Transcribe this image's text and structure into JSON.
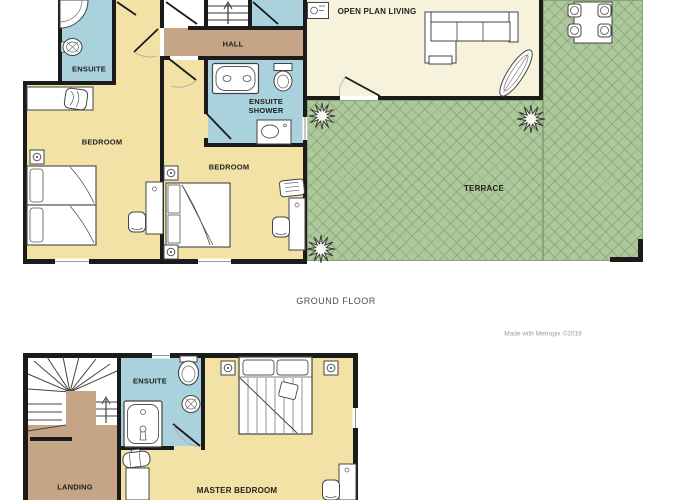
{
  "colors": {
    "wall": "#1b1b1b",
    "yellow": "#F2E2A6",
    "blue": "#A9D2DC",
    "brown": "#C5A586",
    "cream": "#F6F2DC",
    "green": "#ADC99C",
    "green-line": "#87A576",
    "label": "#1f1f1f",
    "caption": "#4f4f4f",
    "credit": "#9b9b9b"
  },
  "ground_floor": {
    "caption": "GROUND FLOOR",
    "rooms": {
      "ensuite": "ENSUITE",
      "hall": "HALL",
      "open_plan_living": "OPEN PLAN LIVING",
      "ensuite_shower": "ENSUITE SHOWER",
      "bedroom_left": "BEDROOM",
      "bedroom_middle": "BEDROOM",
      "terrace": "TERRACE"
    }
  },
  "first_floor": {
    "rooms": {
      "landing": "LANDING",
      "ensuite": "ENSUITE",
      "master_bedroom": "MASTER BEDROOM"
    }
  },
  "credit": "Made with Metropix ©2019"
}
